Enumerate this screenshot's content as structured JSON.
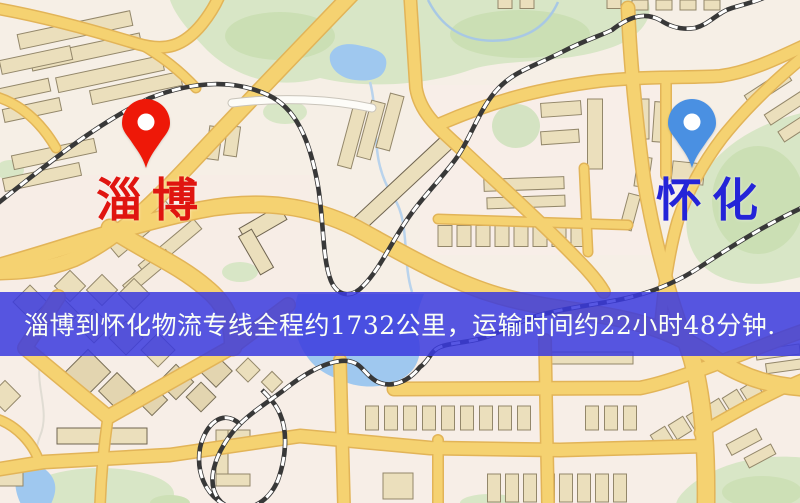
{
  "markers": {
    "origin": {
      "name": "淄博",
      "pin_color": "#ee1808",
      "label_color": "#e01510"
    },
    "destination": {
      "name": "怀化",
      "pin_color": "#4a90e2",
      "label_color": "#2424d8"
    }
  },
  "banner": {
    "text": "淄博到怀化物流专线全程约1732公里，运输时间约22小时48分钟.",
    "background_color": "rgba(58,58,222,0.85)",
    "text_color": "#fafff5",
    "route": {
      "origin": "淄博",
      "destination": "怀化",
      "distance": "约1732公里",
      "duration": "约22小时48分钟"
    }
  },
  "palette": {
    "map_background": "#f6efe6",
    "road_fill": "#f5d271",
    "road_casing": "#e2b458",
    "building_fill": "#ebdfbc",
    "green_area": "#d8e6c6",
    "water": "#9fc8ef",
    "railway": "#383838"
  }
}
